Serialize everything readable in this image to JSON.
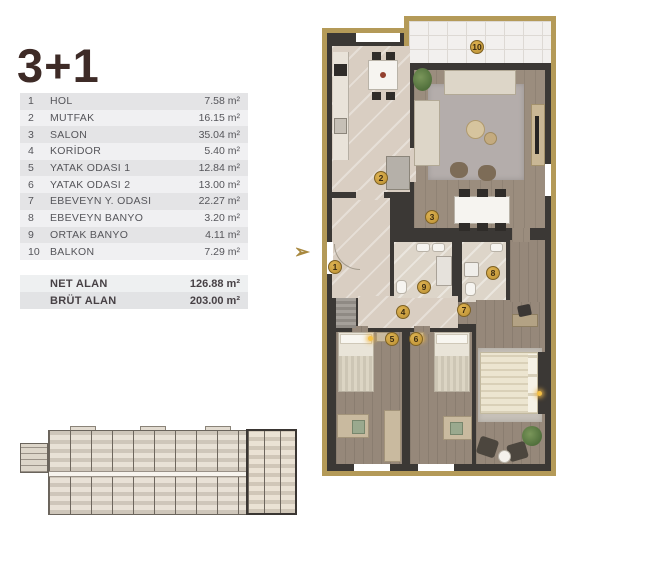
{
  "title": "3+1",
  "table": {
    "rows": [
      {
        "no": "1",
        "name": "HOL",
        "area": "7.58 m²"
      },
      {
        "no": "2",
        "name": "MUTFAK",
        "area": "16.15 m²"
      },
      {
        "no": "3",
        "name": "SALON",
        "area": "35.04 m²"
      },
      {
        "no": "4",
        "name": "KORİDOR",
        "area": "5.40 m²"
      },
      {
        "no": "5",
        "name": "YATAK ODASI 1",
        "area": "12.84 m²"
      },
      {
        "no": "6",
        "name": "YATAK ODASI 2",
        "area": "13.00 m²"
      },
      {
        "no": "7",
        "name": "EBEVEYN Y. ODASI",
        "area": "22.27 m²"
      },
      {
        "no": "8",
        "name": "EBEVEYN BANYO",
        "area": "3.20 m²"
      },
      {
        "no": "9",
        "name": "ORTAK BANYO",
        "area": "4.11 m²"
      },
      {
        "no": "10",
        "name": "BALKON",
        "area": "7.29 m²"
      }
    ],
    "summary": [
      {
        "label": "NET ALAN",
        "value": "126.88 m²"
      },
      {
        "label": "BRÜT ALAN",
        "value": "203.00 m²"
      }
    ]
  },
  "plan": {
    "entry_arrow": "➢",
    "badges": [
      {
        "n": "1",
        "room": "hol",
        "x": 335,
        "y": 267
      },
      {
        "n": "2",
        "room": "mutfak",
        "x": 381,
        "y": 178
      },
      {
        "n": "3",
        "room": "salon",
        "x": 432,
        "y": 217
      },
      {
        "n": "4",
        "room": "koridor",
        "x": 403,
        "y": 312
      },
      {
        "n": "5",
        "room": "yatak-odasi-1",
        "x": 392,
        "y": 339
      },
      {
        "n": "6",
        "room": "yatak-odasi-2",
        "x": 416,
        "y": 339
      },
      {
        "n": "7",
        "room": "ebeveyn-y-odasi",
        "x": 464,
        "y": 310
      },
      {
        "n": "8",
        "room": "ebeveyn-banyo",
        "x": 493,
        "y": 273
      },
      {
        "n": "9",
        "room": "ortak-banyo",
        "x": 424,
        "y": 287
      },
      {
        "n": "10",
        "room": "balkon",
        "x": 477,
        "y": 47
      }
    ]
  },
  "colors": {
    "gold_border": "#b49a58",
    "wall": "#3b3835",
    "title_text": "#3e2b27",
    "row_odd": "#e4e4e6",
    "row_even": "#f0f0f2",
    "badge_gold": "#c79b3f"
  }
}
